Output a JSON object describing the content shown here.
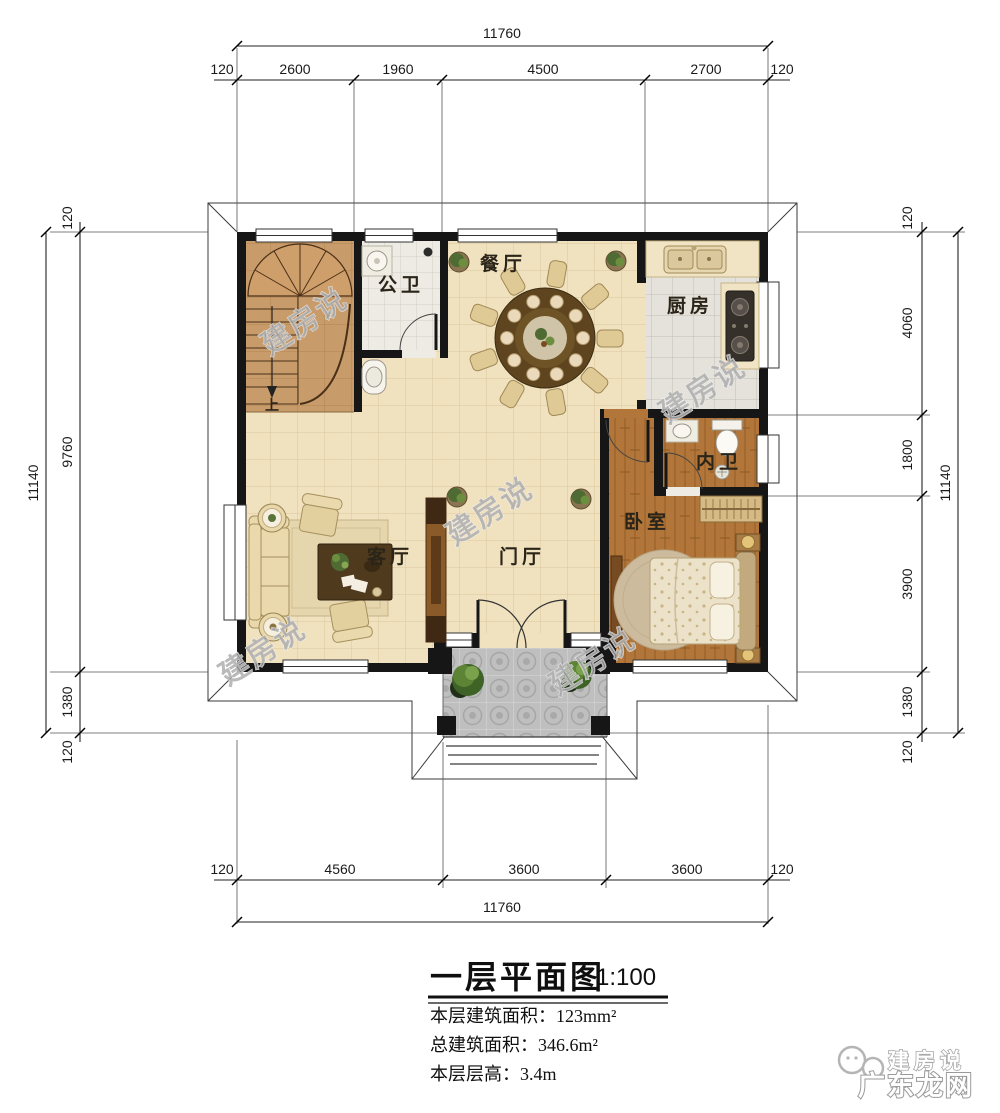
{
  "dimensions": {
    "top": {
      "overall": "11760",
      "segments": [
        "120",
        "2600",
        "1960",
        "4500",
        "2700",
        "120"
      ]
    },
    "bottom": {
      "overall": "11760",
      "segments": [
        "120",
        "4560",
        "3600",
        "3600",
        "120"
      ]
    },
    "left": {
      "overall": "11140",
      "segments": [
        "120",
        "9760",
        "1380",
        "120"
      ]
    },
    "right": {
      "overall": "11140",
      "segments": [
        "120",
        "4060",
        "1800",
        "3900",
        "1380",
        "120"
      ]
    }
  },
  "rooms": {
    "dining": "餐厅",
    "guest_bath": "公卫",
    "kitchen": "厨房",
    "inner_bath": "内卫",
    "bedroom": "卧室",
    "living": "客厅",
    "foyer": "门厅",
    "stair_up": "上"
  },
  "title_block": {
    "title": "一层平面图",
    "scale": "1:100",
    "floor_area": "本层建筑面积：123mm²",
    "total_area": "总建筑面积：346.6m²",
    "floor_height": "本层层高：3.4m"
  },
  "watermark": {
    "stamp": "建房说",
    "brand_top": "建房说",
    "brand_bottom": "广东龙网"
  },
  "colors": {
    "wall": "#161616",
    "floor_cream": "#f1e2bf",
    "floor_wood": "#b2763a",
    "floor_tile": "#edebe4",
    "floor_kitchen": "#e4e2db",
    "floor_stair": "#c89b6b",
    "porch": "#bfbfbf"
  }
}
